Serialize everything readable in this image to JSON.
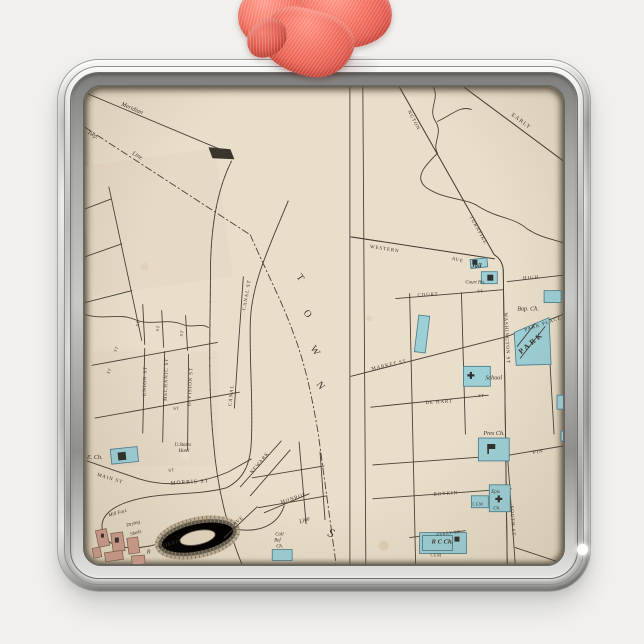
{
  "style": {
    "background": "#f1f0ee",
    "ribbon": "#f2685c",
    "frame_silver": "#d6d6d4",
    "paper": "#e8dec9",
    "ink": "#3a332b",
    "landmark_blue": "#9ccfd6",
    "factory_red": "#cfa091"
  },
  "map": {
    "left": {
      "meridian": "Meridian",
      "twp": "Twp.",
      "line": "Line",
      "line2": "Line",
      "st": "ST",
      "union": "UNION ST",
      "mechanic": "MECHANIC ST",
      "division": "DIVISION ST",
      "canal_st": "CANAL ST",
      "canal": "CANAL",
      "town": [
        "T",
        "O",
        "W",
        "N"
      ],
      "s": "S",
      "main": "MAIN ST",
      "morris": "MORRIS ST",
      "newark": "NEWARK",
      "monroe": "MONROE",
      "ave": "AVE",
      "morris_lower": "MORRIS",
      "e_ch": "E. Ch.",
      "hotel": [
        "U.States",
        "Hotel"
      ],
      "mill": "Mill Fact.",
      "drying": [
        "Drying",
        "Sheds"
      ],
      "r": "R",
      "coll": [
        "Coll",
        "Ref",
        "Ch."
      ]
    },
    "right": {
      "ngton": "NGTON",
      "turnpike": "TURNPIKE",
      "early": "EARLY",
      "western": "WESTERN",
      "ave": "AVE",
      "jail": "Jail",
      "court_ho": "Court Ho.",
      "court": "COURT",
      "st": "ST",
      "high": "HIGH",
      "washington": "WASHINGTON ST",
      "bap_ch": "Bap. Ch.",
      "park_place": "PARK PLACE",
      "park": "PARK",
      "market": "MARKET ST",
      "school": "School",
      "de_hart": "DE HART",
      "pres_ch": "Pres Ch.",
      "pin": "PIN",
      "boykin": "BOYKIN",
      "perry": "PERRY ST",
      "south": "SOUTH ST",
      "cem": "CEM",
      "epis": "Epis",
      "ch": "Ch.",
      "rc_ch": "R C Ch."
    }
  }
}
